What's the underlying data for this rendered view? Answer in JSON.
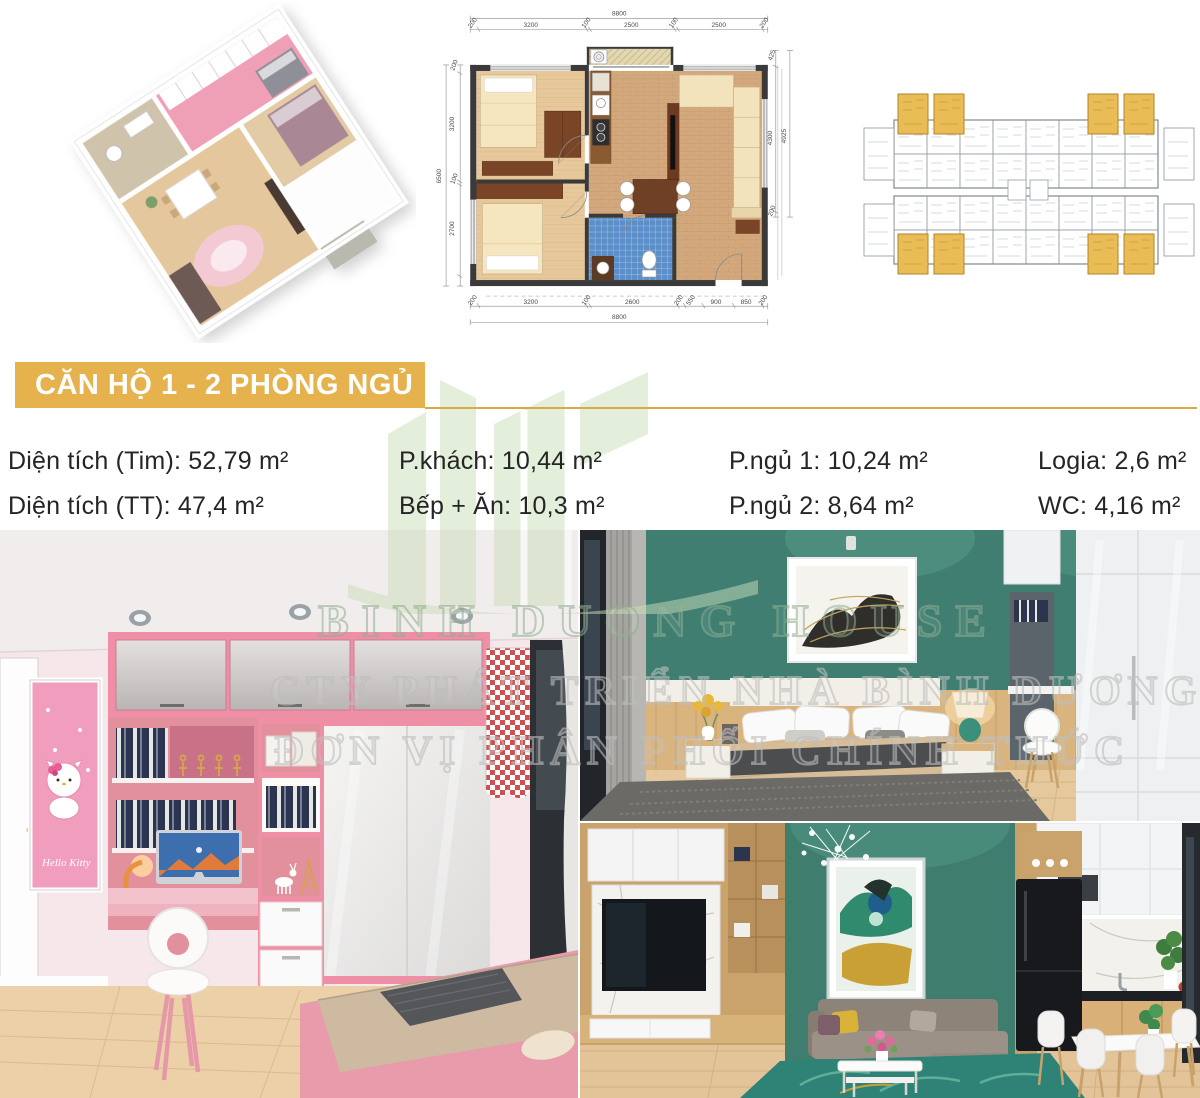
{
  "banner": {
    "title": "CĂN HỘ 1 - 2 PHÒNG NGỦ"
  },
  "specs": {
    "items": [
      "Diện tích (Tim): 52,79 m²",
      "Diện tích (TT): 47,4 m²",
      "P.khách: 10,44 m²",
      "Bếp + Ăn: 10,3 m²",
      "P.ngủ 1: 10,24 m²",
      "P.ngủ 2: 8,64 m²",
      "Logia: 2,6 m²",
      "WC: 4,16 m²"
    ]
  },
  "floorplan": {
    "overall_width_top": "8800",
    "top": [
      "200",
      "3200",
      "100",
      "2500",
      "100",
      "2500",
      "200"
    ],
    "overall_width_bottom": "8800",
    "bottom": [
      "200",
      "3200",
      "100",
      "2600",
      "200",
      "550",
      "900",
      "850",
      "200"
    ],
    "left": [
      "200",
      "3200",
      "100",
      "2700"
    ],
    "overall_left": "6500",
    "right": [
      "425",
      "4300",
      "200"
    ],
    "overall_right": "4925"
  },
  "watermark": {
    "line1": "BINH DUONG HOUSE",
    "line2": "CTY PHÁT TRIỂN NHÀ BÌNH DƯƠNG",
    "line3": "ĐƠN VỊ PHÂN PHỐI CHÍNH THỨC"
  },
  "kids_room": {
    "art_caption": "Hello Kitty"
  },
  "colors": {
    "banner_gold": "#e6b24e",
    "accent_teal": "#3f7e71",
    "accent_pink": "#ef8fa6",
    "highlight_unit_yellow": "#e9bc55",
    "watermark_green": "#c9dfb9"
  }
}
